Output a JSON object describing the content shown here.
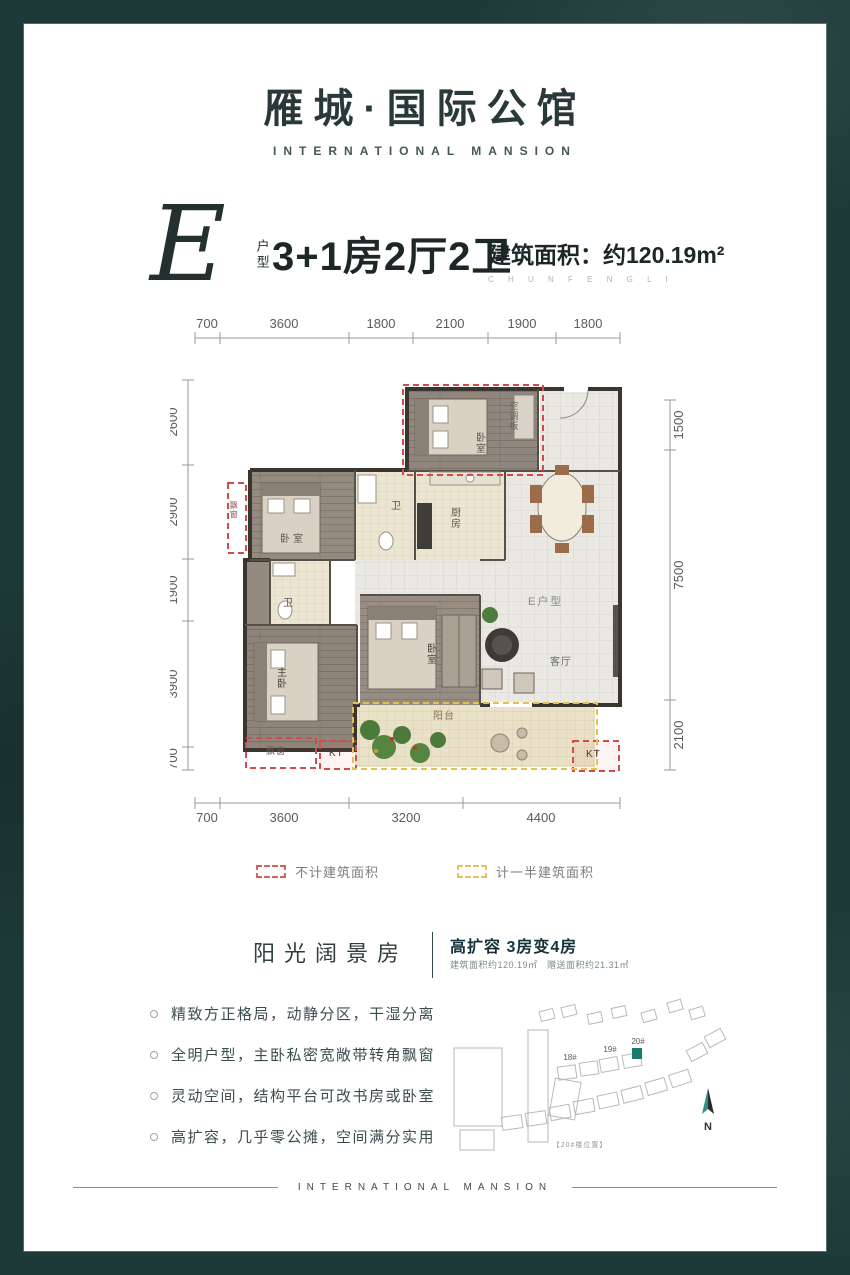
{
  "header": {
    "title": "雁城·国际公馆",
    "subtitle": "INTERNATIONAL MANSION"
  },
  "unit": {
    "letter": "E",
    "label": "户型",
    "rooms": "3+1房2厅2卫",
    "area": "建筑面积：约120.19m²",
    "area_sub": "C H U N F E N G L I"
  },
  "plan": {
    "dims_top": [
      "700",
      "3600",
      "1800",
      "2100",
      "1900",
      "1800"
    ],
    "dims_bottom": [
      "700",
      "3600",
      "3200",
      "4400"
    ],
    "dims_left": [
      "2600",
      "2900",
      "1900",
      "3900",
      "700"
    ],
    "dims_right": [
      "1500",
      "7500",
      "2100"
    ],
    "labels": {
      "bedroom_top": "卧室",
      "ac_board": "空调板",
      "bedroom_left": "卧室",
      "bath_1": "卫",
      "kitchen": "厨房",
      "bath_2": "卫",
      "master_bedroom": "主卧",
      "bedroom_mid": "卧室",
      "living_room": "客厅",
      "unit_tag": "E户型",
      "balcony": "阳台",
      "bay_window_left": "飘窗",
      "bay_window_bottom": "飘窗",
      "kt_left": "KT",
      "kt_right": "KT"
    }
  },
  "legend": {
    "excluded": "不计建筑面积",
    "half": "计一半建筑面积"
  },
  "feature": {
    "name": "阳光阔景房",
    "headline": "高扩容 3房变4房",
    "detail": "建筑面积约120.19㎡　赠送面积约21.31㎡"
  },
  "bullets": [
    "精致方正格局，动静分区，干湿分离",
    "全明户型，主卧私密宽敞带转角飘窗",
    "灵动空间，结构平台可改书房或卧室",
    "高扩容，几乎零公摊，空间满分实用"
  ],
  "siteplan": {
    "b18": "18#",
    "b19": "19#",
    "b20": "20#",
    "north": "N",
    "caption": "【20#楼位置】"
  },
  "footer": {
    "band": "INTERNATIONAL MANSION"
  }
}
